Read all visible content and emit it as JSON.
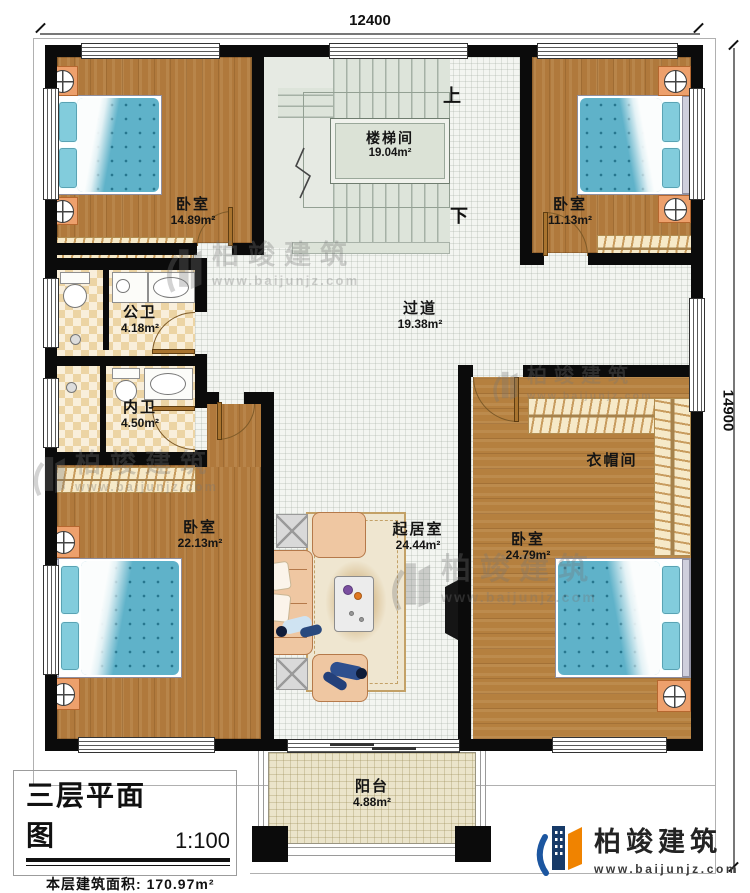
{
  "dimensions": {
    "top": "12400",
    "right": "14900"
  },
  "rooms": [
    {
      "id": "bedroom-top-left",
      "name": "卧室",
      "area": "14.89m²"
    },
    {
      "id": "stairwell",
      "name": "楼梯间",
      "area": "19.04m²"
    },
    {
      "id": "bedroom-top-right",
      "name": "卧室",
      "area": "11.13m²"
    },
    {
      "id": "public-bathroom",
      "name": "公卫",
      "area": "4.18m²"
    },
    {
      "id": "private-bathroom",
      "name": "内卫",
      "area": "4.50m²"
    },
    {
      "id": "corridor",
      "name": "过道",
      "area": "19.38m²"
    },
    {
      "id": "bedroom-bottom-left",
      "name": "卧室",
      "area": "22.13m²"
    },
    {
      "id": "living-room",
      "name": "起居室",
      "area": "24.44m²"
    },
    {
      "id": "cloakroom",
      "name": "衣帽间"
    },
    {
      "id": "bedroom-bottom-right",
      "name": "卧室",
      "area": "24.79m²"
    },
    {
      "id": "balcony",
      "name": "阳台",
      "area": "4.88m²"
    }
  ],
  "stairs": {
    "up": "上",
    "down": "下"
  },
  "title_block": {
    "title": "三层平面图",
    "scale": "1:100",
    "area_label": "本层建筑面积:",
    "area_value": "170.97m²",
    "height_label": "层高:",
    "height_value": "3.3m"
  },
  "brand": {
    "name": "柏竣建筑",
    "url": "www.baijunjz.com"
  },
  "watermark": {
    "name": "柏竣建筑",
    "url": "www.baijunjz.com"
  },
  "colors": {
    "wall": "#0b0b0b",
    "wood": "#b0793c",
    "tile_dark": "#ecd4a4",
    "tile_light": "#f9efdb",
    "corridor": "#f3f5f1",
    "stair": "#e6eae3",
    "balcony": "#ebe4ca",
    "bed_blue": "#5fb2c9",
    "pillow_blue": "#82ccdc",
    "nightstand": "#eda06c",
    "wardrobe": "#f6e9c8",
    "sofa_peach": "#efc7a2",
    "logo_blue": "#1c56a0",
    "logo_navy": "#173a68",
    "logo_orange": "#f08300"
  }
}
